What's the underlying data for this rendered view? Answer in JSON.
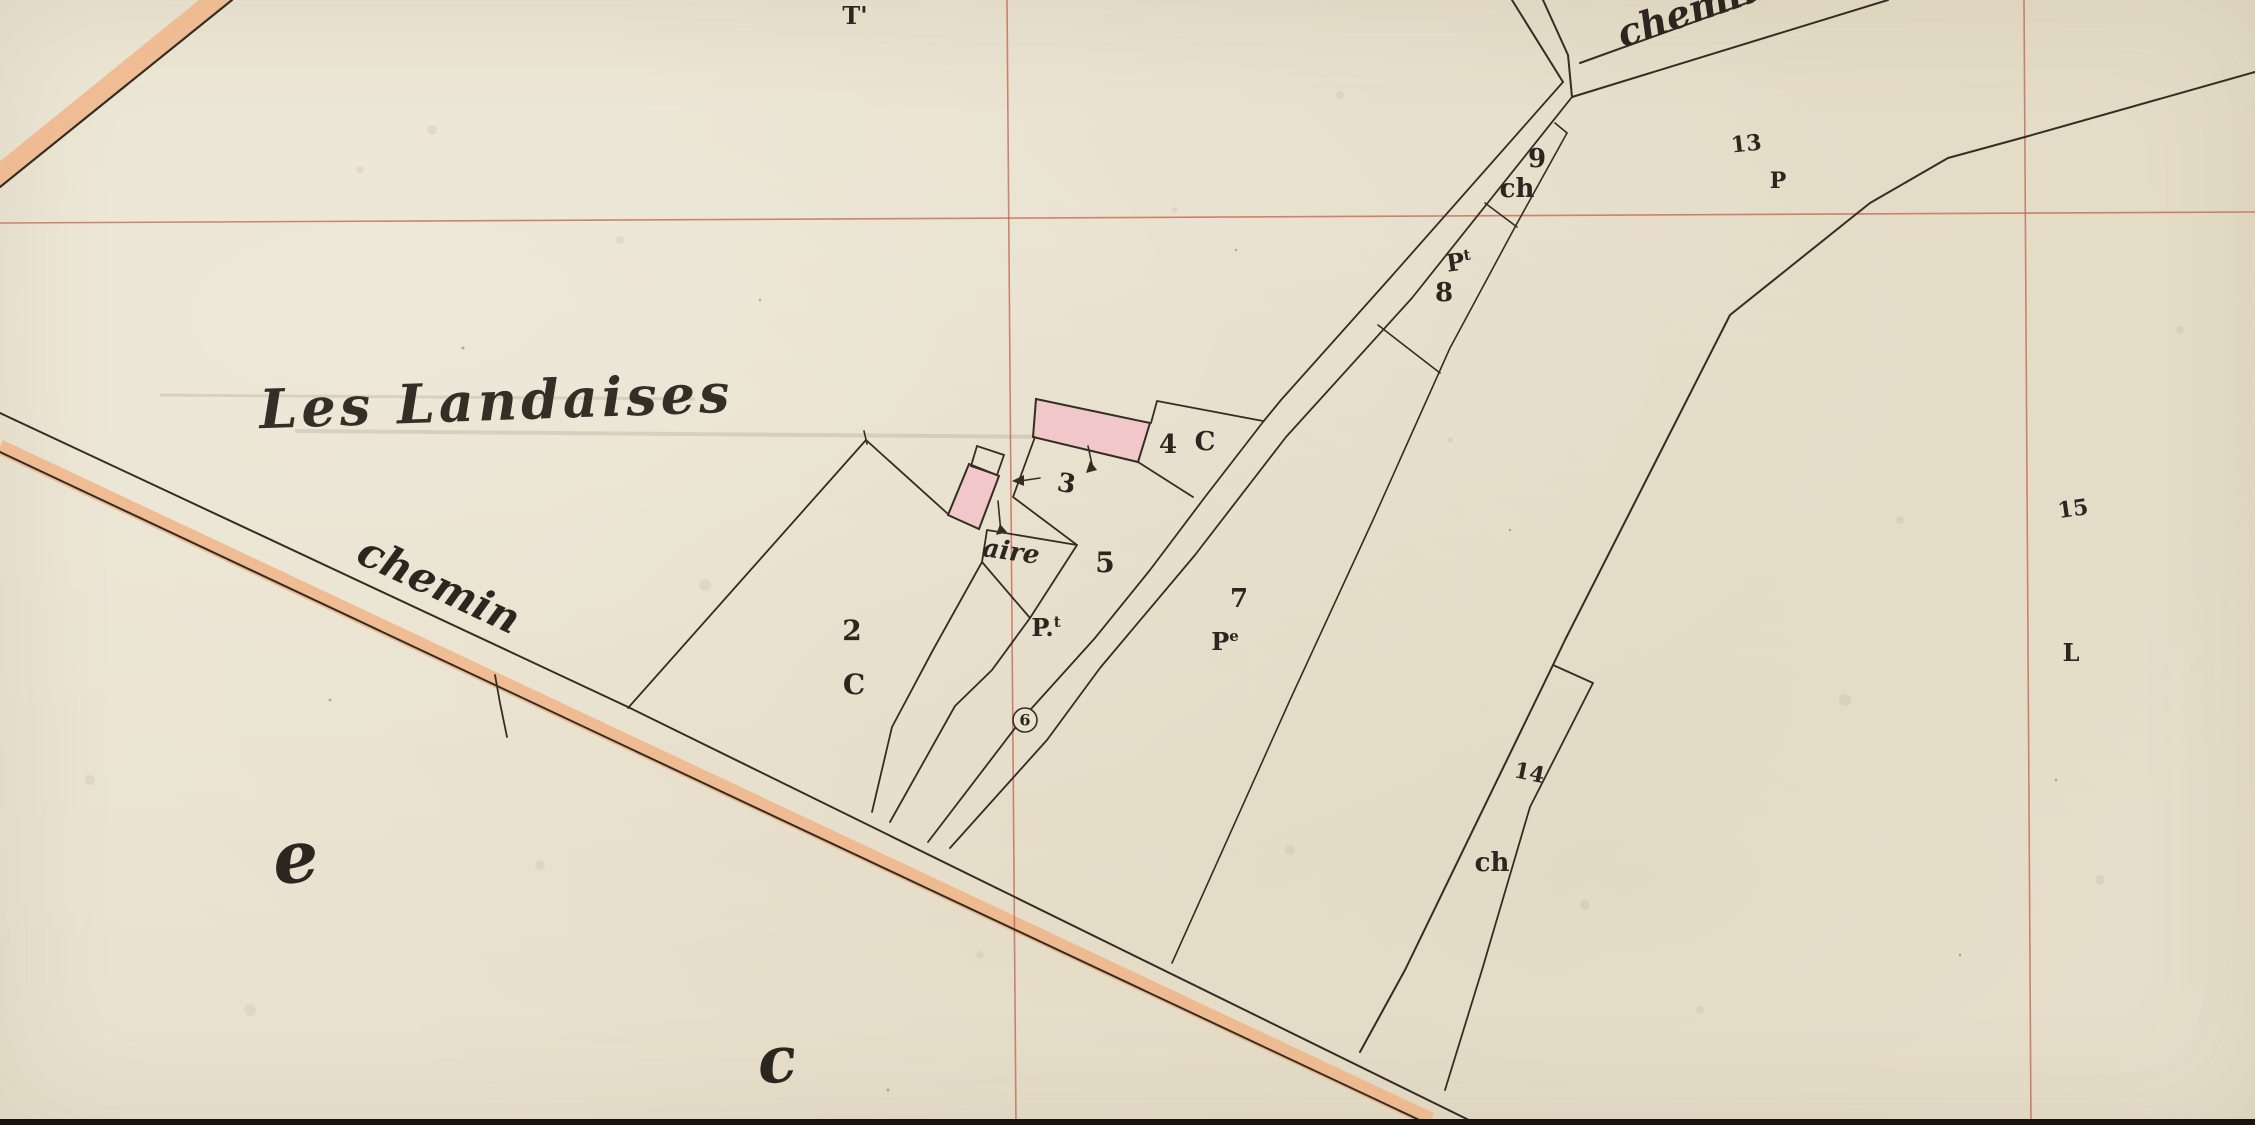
{
  "palette": {
    "paper": "#e9e2cf",
    "ink": "#332d23",
    "red_grid": "#c05a44",
    "road_wash": "#f0b183",
    "building_fill": "#f1c7ca",
    "scan_border": "#17130e"
  },
  "map": {
    "width": 2255,
    "height": 1125,
    "bands": [
      {
        "id": "road-bottom-orange-wash",
        "points": "0,447 1431,1120",
        "w": 15,
        "color": "#f0b183",
        "opacity": 0.8
      },
      {
        "id": "road-topleft-orange-wash",
        "points": "-6,179 226,-9",
        "w": 20,
        "color": "#f0b183",
        "opacity": 0.8
      }
    ],
    "pencil_lines": [
      {
        "id": "pencil-smudge-1",
        "points": "160,395 695,399",
        "w": 3,
        "color": "rgba(110,95,70,0.16)"
      },
      {
        "id": "pencil-smudge-2",
        "points": "295,431 1058,437",
        "w": 4,
        "color": "rgba(110,95,70,0.16)"
      }
    ],
    "grid_lines": [
      {
        "id": "red-grid-horizontal",
        "points": "0,223 2255,212"
      },
      {
        "id": "red-grid-vertical-left",
        "points": "1007,0 1016,1125"
      },
      {
        "id": "red-grid-vertical-right",
        "points": "2024,0 2031,1125"
      }
    ],
    "grid_color": "#c05a44",
    "buildings": [
      {
        "id": "building-main-pink",
        "points": "1036,399 1150,423 1138,462 1033,437",
        "fill": "#f1c7ca",
        "w": 2
      },
      {
        "id": "building-small-pink",
        "points": "948,515 969,464 999,476 979,529",
        "fill": "#f1c7ca",
        "w": 2
      },
      {
        "id": "building-small-annex",
        "points": "971,466 977,446 1004,455 997,475",
        "fill": "none",
        "w": 1.8
      }
    ],
    "lines": [
      {
        "id": "road-topleft-edge",
        "points": "0,187 232,0",
        "w": 2.2
      },
      {
        "id": "road-bottom-upper-edge",
        "points": "0,413 628,707 1479,1125",
        "w": 2
      },
      {
        "id": "road-bottom-lower-edge",
        "points": "0,452 1430,1125",
        "w": 2
      },
      {
        "id": "road-bottom-boundary-tick",
        "points": "495,675 500,703 507,737",
        "w": 1.8
      },
      {
        "id": "road-north-left-edge",
        "points": "1512,0 1563,82",
        "w": 2
      },
      {
        "id": "road-north-right-edge",
        "points": "1543,0 1568,55 1572,97",
        "w": 2
      },
      {
        "id": "road-northeast-upper-edge",
        "points": "1580,63 1755,0",
        "w": 2
      },
      {
        "id": "road-northeast-lower-edge",
        "points": "1572,97 1888,0",
        "w": 2
      },
      {
        "id": "road-center-west-edge",
        "points": "1563,82 1390,278 1281,400 1263,422 1205,497 1150,570 1095,638 1022,719 928,842",
        "w": 1.8
      },
      {
        "id": "road-center-east-edge",
        "points": "1572,97 1412,298 1286,437 1195,555 1100,668 1047,740 950,848",
        "w": 1.8
      },
      {
        "id": "parcel-2-left-boundary",
        "points": "866,440 628,708",
        "w": 1.8
      },
      {
        "id": "parcel-2-corner-tick",
        "points": "864,431 867,444",
        "w": 1.6
      },
      {
        "id": "parcel-2-top-boundary",
        "points": "866,440 948,514",
        "w": 1.8
      },
      {
        "id": "parcel-2-right-boundary",
        "points": "982,562 933,650 892,727 872,812",
        "w": 1.8
      },
      {
        "id": "parcel-5-west-boundary",
        "points": "1030,618 992,670 955,706 890,822",
        "w": 1.8
      },
      {
        "id": "parcel-aire-outline",
        "points": "987,530 1077,545 1030,618 982,562 987,530",
        "w": 1.8
      },
      {
        "id": "parcel-3-bottom-boundary",
        "points": "1035,437 1013,497 1077,545",
        "w": 1.8
      },
      {
        "id": "parcel-4-top-boundary",
        "points": "1151,423 1157,401 1263,421",
        "w": 1.8
      },
      {
        "id": "parcel-4-bottom-boundary",
        "points": "1138,462 1193,497",
        "w": 1.8
      },
      {
        "id": "strip-parcel-right-boundary",
        "points": "1567,133 1515,227 1450,348 1373,520 1290,700 1172,963",
        "w": 1.6
      },
      {
        "id": "parcel-9-top-bracket",
        "points": "1555,123 1567,133",
        "w": 1.6
      },
      {
        "id": "parcel-9-8-division",
        "points": "1485,203 1517,227",
        "w": 1.6
      },
      {
        "id": "parcel-8-lower-division",
        "points": "1378,325 1440,373",
        "w": 1.6
      },
      {
        "id": "east-long-boundary",
        "points": "2255,72 2025,137 1948,158 1870,203 1730,315 1565,640 1553,665 1405,970 1360,1052",
        "w": 2
      },
      {
        "id": "parcel-14-notch",
        "points": "1553,665 1593,683",
        "w": 1.8
      },
      {
        "id": "parcel-14-right-boundary",
        "points": "1593,683 1530,807 1482,970 1445,1090",
        "w": 1.8
      }
    ],
    "arrows": [
      {
        "id": "survey-arrow-main-building",
        "line": "1088,446 1093,469",
        "head": "1086,473 1097,470 1090,461"
      },
      {
        "id": "survey-arrow-small-building",
        "line": "998,501 1001,533",
        "head": "996,535 1007,532 1000,524"
      },
      {
        "id": "survey-arrow-parcel-3",
        "line": "1040,478 1020,481",
        "head": "1012,481 1024,475 1024,486"
      }
    ],
    "labels": [
      {
        "id": "label-les-landaises",
        "text": "Les Landaises",
        "x": 497,
        "y": 420,
        "size": 54,
        "rot": -2,
        "cls": "t-title"
      },
      {
        "id": "label-chemin-southwest",
        "text": "chemin",
        "x": 433,
        "y": 598,
        "size": 42,
        "rot": 25,
        "cls": "t-script"
      },
      {
        "id": "label-chemin-northeast",
        "text": "chemin",
        "x": 1697,
        "y": 22,
        "size": 38,
        "rot": -19,
        "cls": "t-script"
      },
      {
        "id": "label-t-prime",
        "text": "T'",
        "x": 855,
        "y": 24,
        "size": 24,
        "rot": 0,
        "cls": "t-num"
      },
      {
        "id": "label-parcel-9",
        "text": "9",
        "x": 1537,
        "y": 167,
        "size": 26,
        "rot": 0,
        "cls": "t-num"
      },
      {
        "id": "label-parcel-9-ch",
        "text": "ch",
        "x": 1517,
        "y": 197,
        "size": 26,
        "rot": 0,
        "cls": "t-num"
      },
      {
        "id": "label-parcel-8-p",
        "text": "P",
        "sup": "t",
        "x": 1460,
        "y": 270,
        "size": 24,
        "rot": -8,
        "cls": "t-num"
      },
      {
        "id": "label-parcel-8",
        "text": "8",
        "x": 1444,
        "y": 301,
        "size": 26,
        "rot": 0,
        "cls": "t-num"
      },
      {
        "id": "label-parcel-13",
        "text": "13",
        "x": 1747,
        "y": 151,
        "size": 22,
        "rot": -6,
        "cls": "t-num"
      },
      {
        "id": "label-parcel-13-p",
        "text": "P",
        "x": 1778,
        "y": 188,
        "size": 22,
        "rot": 0,
        "cls": "t-num"
      },
      {
        "id": "label-parcel-4",
        "text": "4",
        "x": 1168,
        "y": 453,
        "size": 26,
        "rot": 0,
        "cls": "t-num"
      },
      {
        "id": "label-parcel-4-c",
        "text": "C",
        "x": 1205,
        "y": 450,
        "size": 26,
        "rot": 0,
        "cls": "t-num"
      },
      {
        "id": "label-parcel-3",
        "text": "3",
        "x": 1065,
        "y": 492,
        "size": 26,
        "rot": 10,
        "cls": "t-num"
      },
      {
        "id": "label-aire",
        "text": "aire",
        "x": 1010,
        "y": 560,
        "size": 26,
        "rot": 8,
        "cls": "t-script"
      },
      {
        "id": "label-parcel-5",
        "text": "5",
        "x": 1105,
        "y": 572,
        "size": 28,
        "rot": 0,
        "cls": "t-num"
      },
      {
        "id": "label-parcel-5-p",
        "text": "P.",
        "sup": "t",
        "x": 1046,
        "y": 636,
        "size": 24,
        "rot": 0,
        "cls": "t-num"
      },
      {
        "id": "label-parcel-7",
        "text": "7",
        "x": 1239,
        "y": 607,
        "size": 26,
        "rot": 0,
        "cls": "t-num"
      },
      {
        "id": "label-parcel-7-p",
        "text": "P",
        "sup": "e",
        "x": 1225,
        "y": 650,
        "size": 24,
        "rot": 0,
        "cls": "t-num"
      },
      {
        "id": "label-parcel-2",
        "text": "2",
        "x": 852,
        "y": 640,
        "size": 28,
        "rot": 0,
        "cls": "t-num"
      },
      {
        "id": "label-parcel-2-c",
        "text": "C",
        "x": 854,
        "y": 694,
        "size": 28,
        "rot": 0,
        "cls": "t-num"
      },
      {
        "id": "label-parcel-14",
        "text": "14",
        "x": 1528,
        "y": 780,
        "size": 22,
        "rot": 12,
        "cls": "t-num"
      },
      {
        "id": "label-parcel-14-ch",
        "text": "ch",
        "x": 1492,
        "y": 871,
        "size": 26,
        "rot": 0,
        "cls": "t-num"
      },
      {
        "id": "label-parcel-15",
        "text": "15",
        "x": 2074,
        "y": 516,
        "size": 22,
        "rot": -8,
        "cls": "t-num"
      },
      {
        "id": "label-parcel-15-l",
        "text": "L",
        "x": 2071,
        "y": 661,
        "size": 24,
        "rot": 0,
        "cls": "t-num"
      },
      {
        "id": "label-section-e",
        "text": "e",
        "x": 298,
        "y": 882,
        "size": 72,
        "rot": -6,
        "cls": "t-script"
      },
      {
        "id": "label-section-c",
        "text": "c",
        "x": 779,
        "y": 1082,
        "size": 64,
        "rot": -6,
        "cls": "t-script"
      }
    ],
    "circle_labels": [
      {
        "id": "label-parcel-6-circled",
        "text": "6",
        "x": 1025,
        "y": 720,
        "r": 12,
        "size": 16
      }
    ],
    "speckles_soft": [
      [
        432,
        130,
        5
      ],
      [
        1340,
        95,
        4
      ],
      [
        705,
        585,
        6
      ],
      [
        1585,
        905,
        5
      ],
      [
        250,
        1010,
        6
      ],
      [
        1900,
        520,
        4
      ],
      [
        1175,
        210,
        3
      ],
      [
        90,
        780,
        5
      ],
      [
        1700,
        1010,
        4
      ],
      [
        2100,
        880,
        5
      ],
      [
        620,
        240,
        4
      ],
      [
        1450,
        440,
        3
      ],
      [
        980,
        955,
        4
      ],
      [
        2180,
        330,
        4
      ],
      [
        540,
        865,
        5
      ],
      [
        1845,
        700,
        6
      ],
      [
        360,
        170,
        4
      ],
      [
        1290,
        850,
        5
      ]
    ],
    "speckles_dark": [
      [
        463,
        348,
        1.5
      ],
      [
        1236,
        250,
        1.2
      ],
      [
        888,
        1090,
        1.5
      ],
      [
        2056,
        780,
        1.3
      ],
      [
        1510,
        530,
        1.2
      ],
      [
        330,
        700,
        1.4
      ],
      [
        760,
        300,
        1.2
      ],
      [
        1960,
        955,
        1.3
      ]
    ],
    "rects": [
      {
        "id": "scan-bottom-border",
        "x": 0,
        "y": 1119,
        "w": 2255,
        "h": 6,
        "fill": "#17130e"
      }
    ]
  }
}
